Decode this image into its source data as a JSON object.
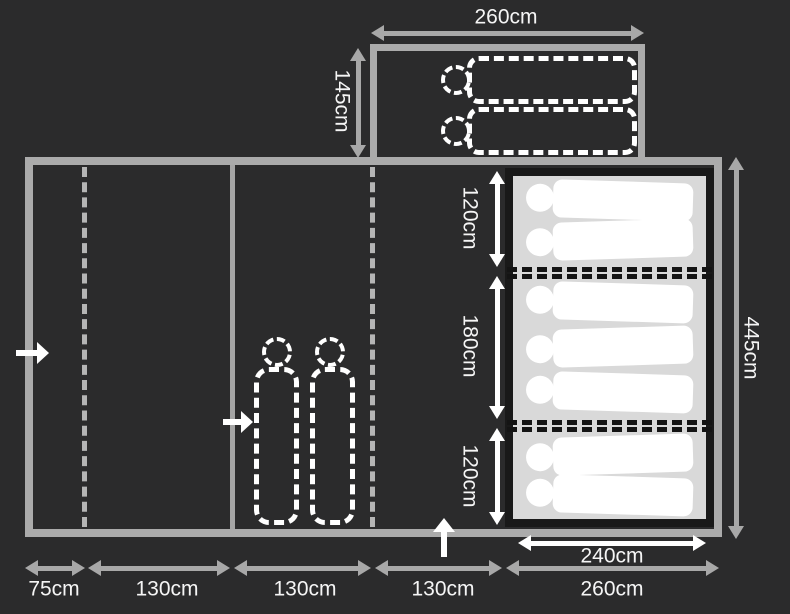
{
  "figure": {
    "type": "tent-floorplan",
    "units": "cm"
  },
  "dimensions": {
    "annex_width": "260cm",
    "annex_depth": "145cm",
    "main_length": "445cm",
    "bedroom_width": "240cm",
    "bedroom_section_heights": [
      "120cm",
      "180cm",
      "120cm"
    ],
    "bottom_section_widths": [
      "75cm",
      "130cm",
      "130cm",
      "130cm",
      "260cm"
    ]
  },
  "sleepers": {
    "annex_sleeping_bags": 2,
    "bedroom_pads_per_section": [
      2,
      3,
      2
    ],
    "living_sleeping_bags": 2
  },
  "colors": {
    "background": "#2b2b2c",
    "frame_gray": "#ababab",
    "dash_gray": "#b5b5b5",
    "arrow_gray": "#a8a8a8",
    "white": "#ffffff",
    "mattress_light": "#d9d9d9",
    "mattress_dark": "#191919",
    "bed_divider_dash": "#141414"
  }
}
